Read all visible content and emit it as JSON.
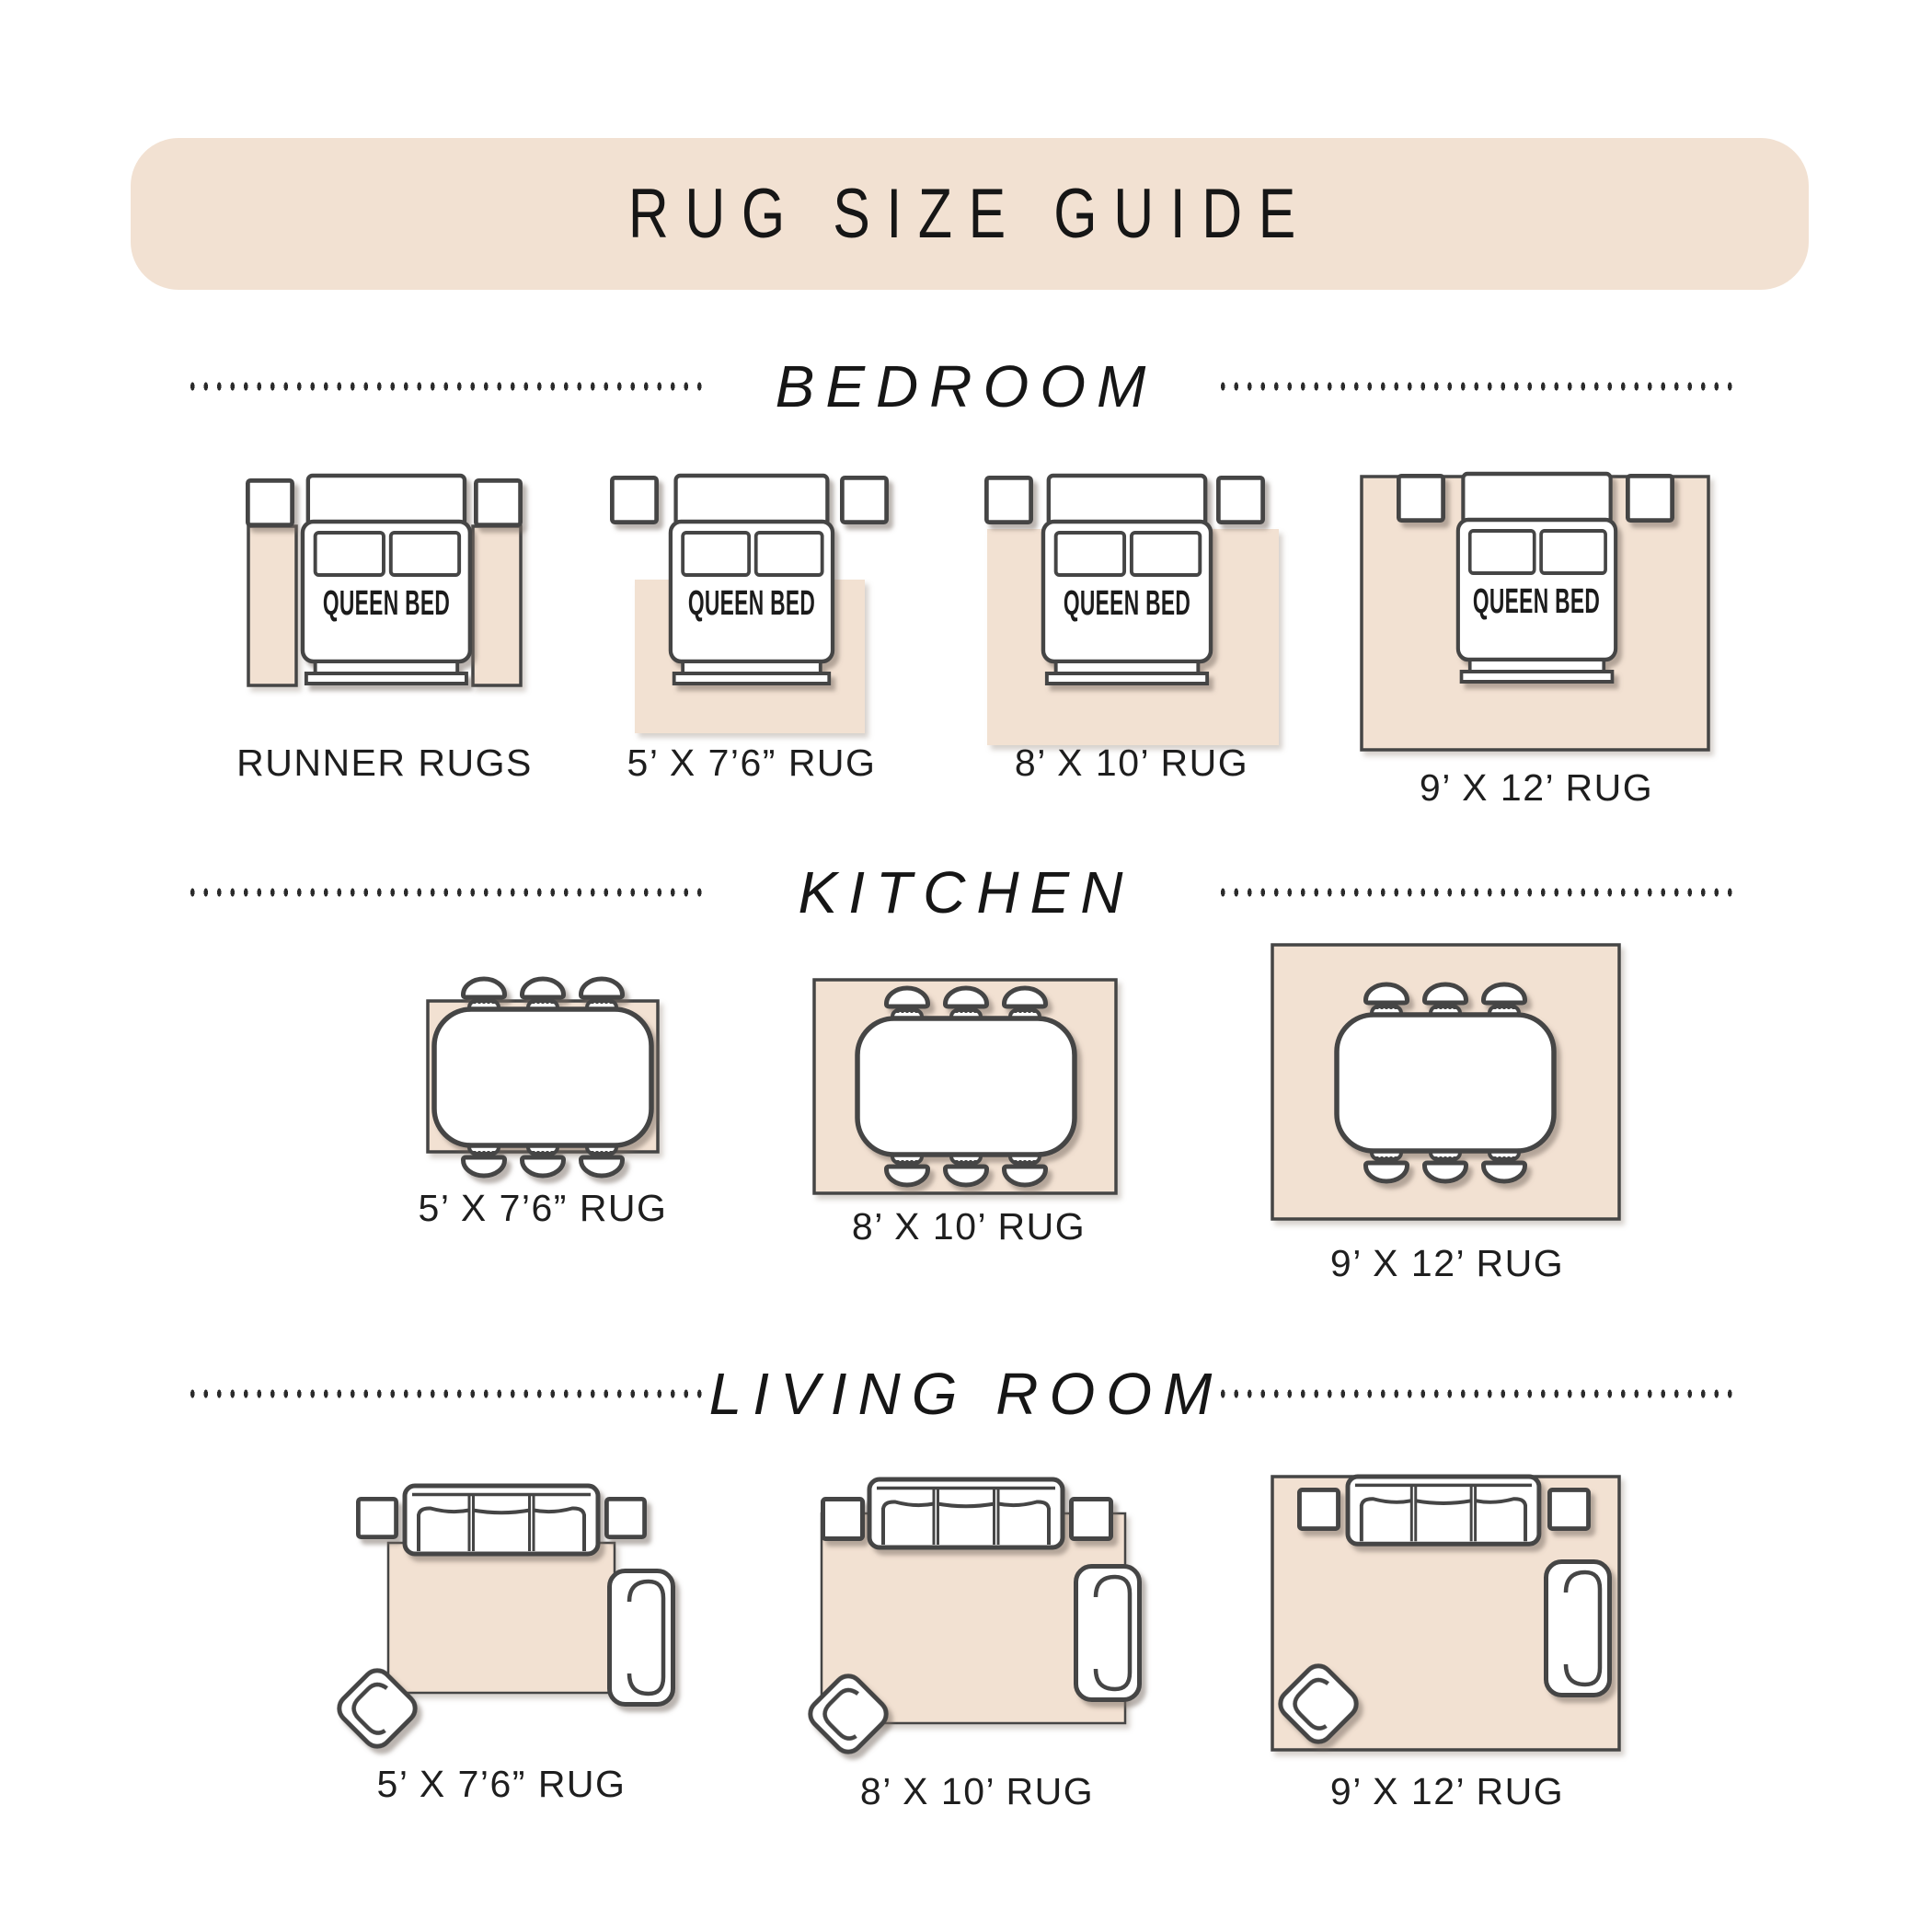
{
  "header": {
    "title": "RUG SIZE GUIDE"
  },
  "colors": {
    "banner_beige": "#f2e1d2",
    "rug_beige": "#f2e1d2",
    "outline_gray": "#444444",
    "text_dark": "#1e1e1e"
  },
  "sections": {
    "bedroom": {
      "title": "BEDROOM",
      "bed_label": "QUEEN BED",
      "items": [
        {
          "label": "RUNNER RUGS"
        },
        {
          "label": "5’ X 7’6” RUG"
        },
        {
          "label": "8’ X 10’ RUG"
        },
        {
          "label": "9’ X 12’ RUG"
        }
      ]
    },
    "kitchen": {
      "title": "KITCHEN",
      "items": [
        {
          "label": "5’ X 7’6” RUG"
        },
        {
          "label": "8’ X 10’ RUG"
        },
        {
          "label": "9’ X 12’ RUG"
        }
      ]
    },
    "living_room": {
      "title": "LIVING ROOM",
      "items": [
        {
          "label": "5’ X 7’6” RUG"
        },
        {
          "label": "8’ X 10’ RUG"
        },
        {
          "label": "9’ X 12’ RUG"
        }
      ]
    }
  }
}
